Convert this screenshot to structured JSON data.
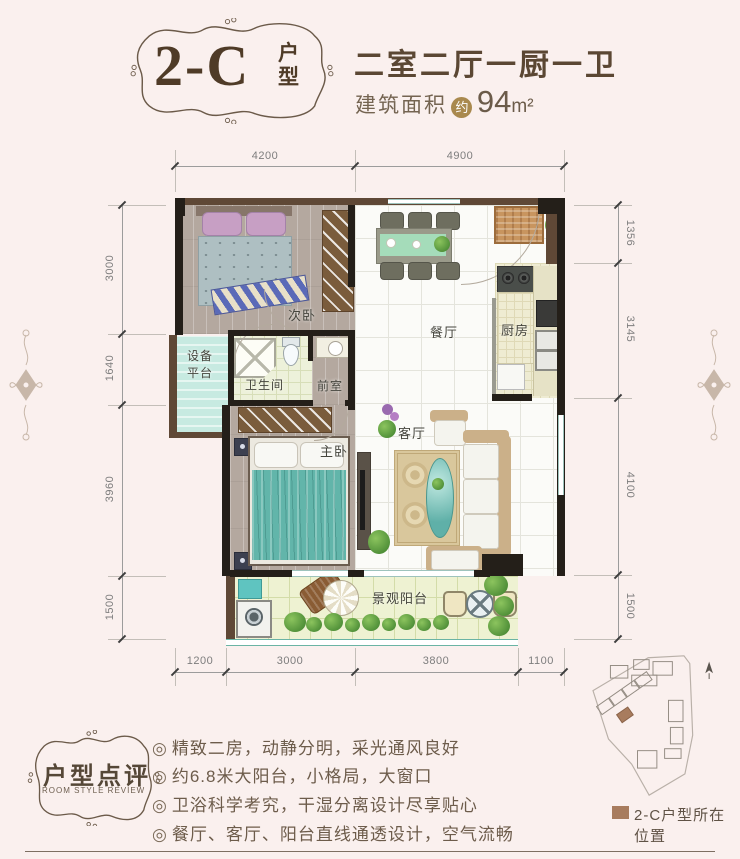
{
  "header": {
    "unit_code": "2-C",
    "unit_word_top": "户",
    "unit_word_bottom": "型",
    "layout_desc": "二室二厅一厨一卫",
    "area_prefix": "建筑面积",
    "area_circle": "约",
    "area_value": "94",
    "area_unit": "m²"
  },
  "plan": {
    "dims": {
      "top": [
        "4200",
        "4900"
      ],
      "left": [
        "3000",
        "1640",
        "3960",
        "1500"
      ],
      "right": [
        "1356",
        "3145",
        "4100",
        "1500"
      ],
      "bottom": [
        "1200",
        "3000",
        "3800",
        "1100"
      ]
    },
    "rooms": {
      "bedroom2": "次卧",
      "dining": "餐厅",
      "kitchen": "厨房",
      "equipment": "设备平台",
      "bathroom": "卫生间",
      "vestibule": "前室",
      "master": "主卧",
      "living": "客厅",
      "balcony": "景观阳台"
    }
  },
  "review": {
    "badge_title": "户型点评",
    "badge_subtitle": "ROOM STYLE REVIEW",
    "bullet_icon": "◎",
    "bullets": [
      "精致二房，动静分明，采光通风良好",
      "约6.8米大阳台，小格局，大窗口",
      "卫浴科学考究，干湿分离设计尽享贴心",
      "餐厅、客厅、阳台直线通透设计，空气流畅"
    ]
  },
  "sitemap": {
    "legend_label": "2-C户型所在位置",
    "highlight_color": "#a87c5e"
  },
  "colors": {
    "background": "#faf0ee",
    "title_brown": "#4f3b27",
    "wall_black": "#241f19",
    "wall_brown": "#5f4836",
    "area_badge_gold": "#a9894e",
    "master_bed_teal": "#62b5aa"
  }
}
